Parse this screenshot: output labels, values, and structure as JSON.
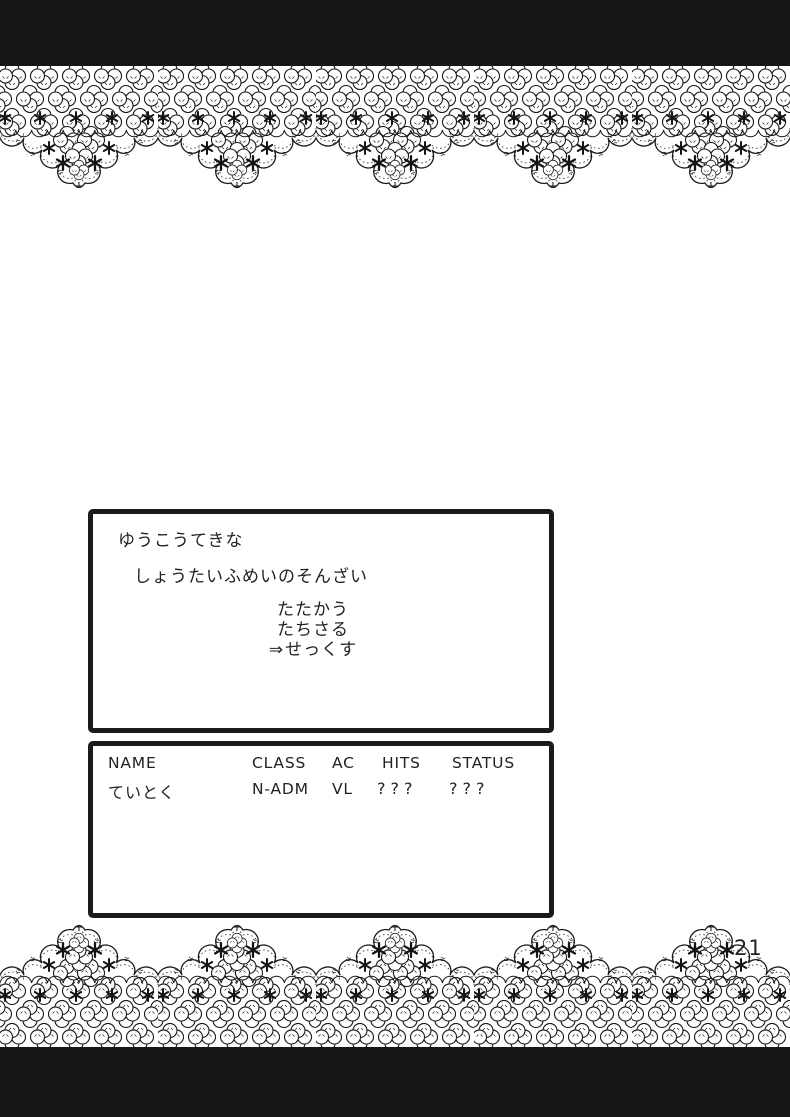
{
  "page": {
    "number": "21",
    "background": "#ffffff",
    "scan_bar_color": "#161616",
    "ink_color": "#1c1c1c"
  },
  "battle_window": {
    "line1": "ゆうこうてきな",
    "line2": "しょうたいふめいのそんざい",
    "cursor": "⇒",
    "options": [
      "たたかう",
      "たちさる",
      "せっくす"
    ]
  },
  "status_window": {
    "headers": [
      "NAME",
      "CLASS",
      "AC",
      "HITS",
      "STATUS"
    ],
    "row": [
      "ていとく",
      "N-ADM",
      "VL",
      "???",
      "???"
    ]
  },
  "decoration": {
    "border_style": "floral-lace-scallop",
    "motifs": [
      "clover-flower",
      "six-ray-star",
      "scallop-edge"
    ]
  }
}
